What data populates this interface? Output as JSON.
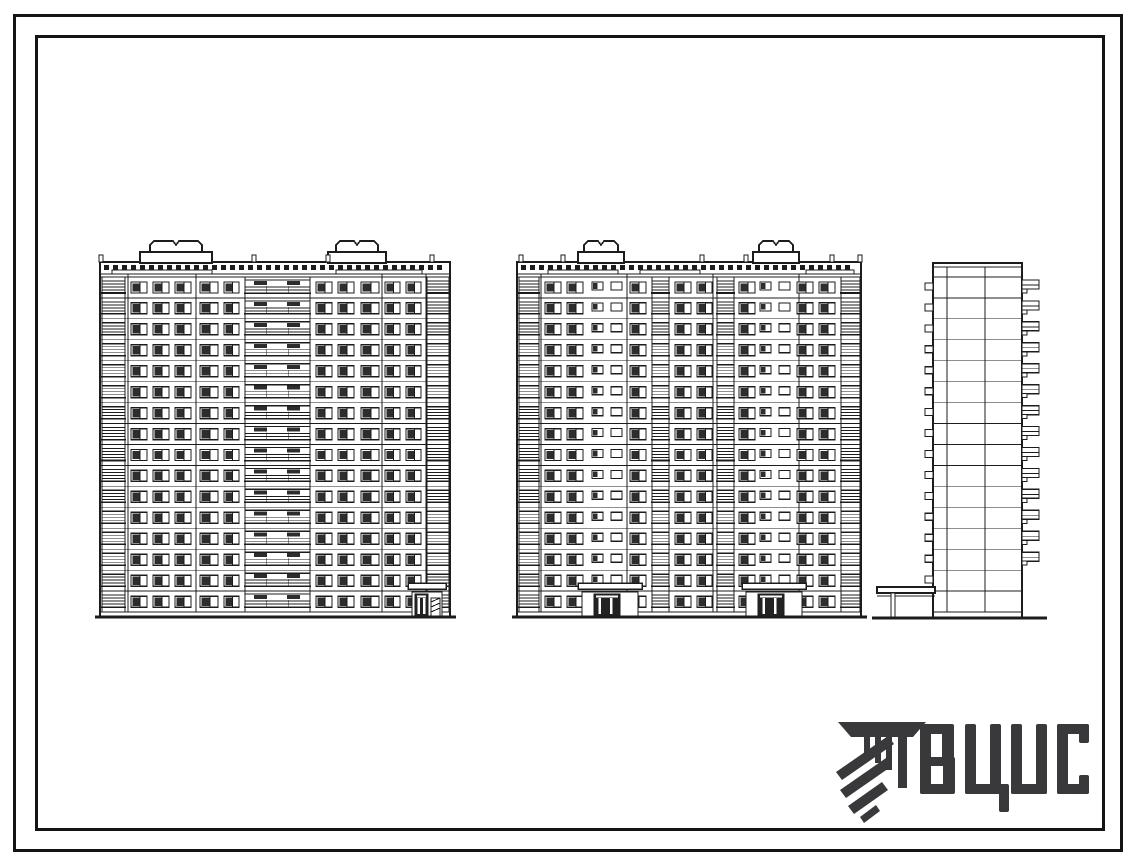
{
  "page": {
    "background": "#ffffff",
    "ink": "#1c1c1c"
  },
  "logo": {
    "text": "ВЦИС",
    "color": "#39393b",
    "emblem": "hatched-column-emblem"
  },
  "drawing": {
    "ink": "#1c1c1c",
    "elevations": [
      {
        "name": "main-facade-elevation",
        "type": "front",
        "left": 100,
        "right": 450,
        "parapetTop": 262,
        "bandLine": 274,
        "storyTop": 277,
        "storyBottom": 612,
        "groundY": 617,
        "groundExt": [
          95,
          456
        ],
        "floors": 16,
        "machineRooms": [
          {
            "x": 140,
            "w": 72,
            "hat": [
              150,
              52
            ]
          },
          {
            "x": 328,
            "w": 58,
            "hat": [
              336,
              42
            ]
          }
        ],
        "vents": [
          99,
          252,
          326,
          430
        ],
        "joints": [
          128,
          196,
          382,
          426
        ],
        "grilles": [
          {
            "x": 112,
            "w": 100
          },
          {
            "x": 336,
            "w": 86
          }
        ],
        "columns": [
          {
            "x": 102,
            "w": 23,
            "t": "balcony"
          },
          {
            "x": 131,
            "w": 16,
            "t": "window"
          },
          {
            "x": 153,
            "w": 16,
            "t": "window"
          },
          {
            "x": 175,
            "w": 16,
            "t": "window"
          },
          {
            "x": 200,
            "w": 18,
            "t": "window"
          },
          {
            "x": 224,
            "w": 15,
            "t": "window"
          },
          {
            "x": 245,
            "w": 65,
            "t": "loggia"
          },
          {
            "x": 316,
            "w": 16,
            "t": "window"
          },
          {
            "x": 338,
            "w": 16,
            "t": "window"
          },
          {
            "x": 361,
            "w": 18,
            "t": "window"
          },
          {
            "x": 385,
            "w": 15,
            "t": "window"
          },
          {
            "x": 406,
            "w": 15,
            "t": "window"
          },
          {
            "x": 427,
            "w": 22,
            "t": "balcony"
          }
        ],
        "entrances": [
          {
            "x": 408,
            "w": 38,
            "doorX": 415,
            "doorW": 13,
            "hatch": true
          }
        ]
      },
      {
        "name": "rear-facade-elevation",
        "type": "front",
        "left": 517,
        "right": 861,
        "parapetTop": 262,
        "bandLine": 274,
        "storyTop": 277,
        "storyBottom": 612,
        "groundY": 617,
        "groundExt": [
          512,
          867
        ],
        "floors": 16,
        "machineRooms": [
          {
            "x": 578,
            "w": 46,
            "hat": [
              584,
              34
            ]
          },
          {
            "x": 753,
            "w": 46,
            "hat": [
              759,
              34
            ]
          }
        ],
        "vents": [
          519,
          561,
          700,
          744,
          830,
          858
        ],
        "joints": [
          541,
          627,
          713,
          799
        ],
        "grilles": [
          {
            "x": 548,
            "w": 70
          },
          {
            "x": 640,
            "w": 60
          },
          {
            "x": 806,
            "w": 48
          }
        ],
        "columns": [
          {
            "x": 519,
            "w": 20,
            "t": "balcony"
          },
          {
            "x": 545,
            "w": 16,
            "t": "window"
          },
          {
            "x": 567,
            "w": 16,
            "t": "window"
          },
          {
            "x": 592,
            "w": 30,
            "t": "smallpair"
          },
          {
            "x": 630,
            "w": 16,
            "t": "window"
          },
          {
            "x": 652,
            "w": 17,
            "t": "balcony"
          },
          {
            "x": 675,
            "w": 16,
            "t": "window"
          },
          {
            "x": 697,
            "w": 15,
            "t": "window"
          },
          {
            "x": 717,
            "w": 17,
            "t": "balcony"
          },
          {
            "x": 739,
            "w": 16,
            "t": "window"
          },
          {
            "x": 760,
            "w": 30,
            "t": "smallpair"
          },
          {
            "x": 797,
            "w": 16,
            "t": "window"
          },
          {
            "x": 819,
            "w": 16,
            "t": "window"
          },
          {
            "x": 841,
            "w": 19,
            "t": "balcony"
          }
        ],
        "entrances": [
          {
            "x": 578,
            "w": 64,
            "doorX": 594,
            "doorW": 26
          },
          {
            "x": 742,
            "w": 64,
            "doorX": 758,
            "doorW": 26
          }
        ]
      },
      {
        "name": "side-end-elevation",
        "type": "side",
        "left": 933,
        "right": 1022,
        "top": 263,
        "bottom": 618,
        "storyTop": 277,
        "storyBottom": 612,
        "floors": 16,
        "joints": [
          947,
          985
        ],
        "balcX": 1022,
        "balcW": 17,
        "balcFloors": 14,
        "stubX": 925,
        "stubFloors": 15,
        "canopy": {
          "x1": 877,
          "x2": 935,
          "y": 587,
          "postX": 891
        },
        "groundExt": [
          872,
          1047
        ]
      }
    ]
  }
}
